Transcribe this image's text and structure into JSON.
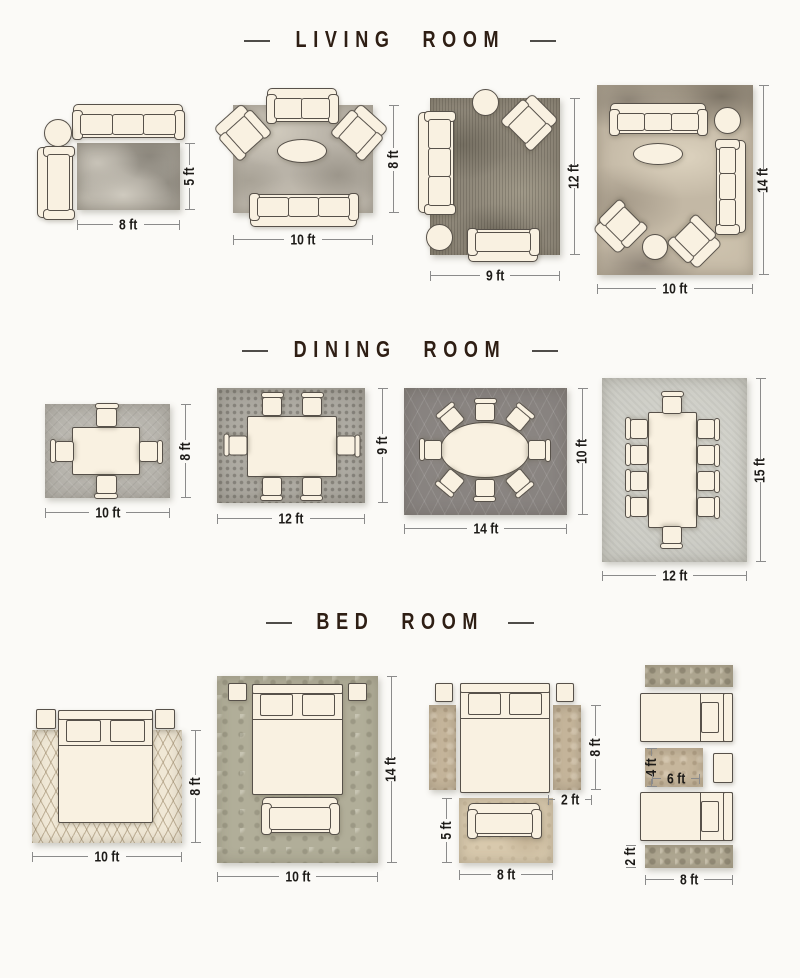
{
  "sections": [
    {
      "title": "LIVING ROOM",
      "layouts": [
        {
          "name": "sofa-with-chaise",
          "rug_width": "8 ft",
          "rug_height": "5 ft"
        },
        {
          "name": "two-sofas-two-armchairs",
          "rug_width": "10 ft",
          "rug_height": "8 ft"
        },
        {
          "name": "sofa-armchair-loveseat",
          "rug_width": "9 ft",
          "rug_height": "12 ft"
        },
        {
          "name": "full-seating-group",
          "rug_width": "10 ft",
          "rug_height": "14 ft"
        }
      ]
    },
    {
      "title": "DINING ROOM",
      "layouts": [
        {
          "name": "square-table-4-chairs",
          "rug_width": "10 ft",
          "rug_height": "8 ft"
        },
        {
          "name": "rect-table-6-chairs",
          "rug_width": "12 ft",
          "rug_height": "9 ft"
        },
        {
          "name": "oval-table-8-chairs",
          "rug_width": "14 ft",
          "rug_height": "10 ft"
        },
        {
          "name": "long-table-10-chairs",
          "rug_width": "12 ft",
          "rug_height": "15 ft"
        }
      ]
    },
    {
      "title": "BED ROOM",
      "layouts": [
        {
          "name": "bed-on-rug",
          "rug_width": "10 ft",
          "rug_height": "8 ft"
        },
        {
          "name": "bed-and-bench-on-rug",
          "rug_width": "10 ft",
          "rug_height": "14 ft"
        },
        {
          "name": "bed-with-side-runners",
          "runner_length": "8 ft",
          "runner_width": "2 ft",
          "foot_rug_height": "5 ft",
          "foot_rug_width": "8 ft"
        },
        {
          "name": "twin-beds-with-runners",
          "center_rug_height": "4 ft",
          "center_rug_width": "6 ft",
          "runner_height": "2 ft",
          "runner_length": "8 ft"
        }
      ]
    }
  ],
  "colors": {
    "furn": "#f9f1e1",
    "line": "#57514a",
    "bg": "#fbfaf7",
    "title": "#2e1e14",
    "dimtxt": "#1d1b18",
    "dimline": "#8b8b8b",
    "rug-concrete": "#a49f95",
    "rug-marble": "#b9b3a8",
    "rug-vintage": "#8e8779",
    "rug-abstract": "#c3b8a5",
    "rug-gray": "#b4b1aa",
    "rug-mosaic": "#a5a29a",
    "rug-trellis": "#85807d",
    "rug-lightgray": "#cbcbc4",
    "rug-ivory": "#f0e8d6",
    "rug-damask": "#b1ae99",
    "rug-tan": "#c6b69c",
    "rug-beige": "#d8c9ad",
    "rug-ornate": "#b0a892"
  }
}
